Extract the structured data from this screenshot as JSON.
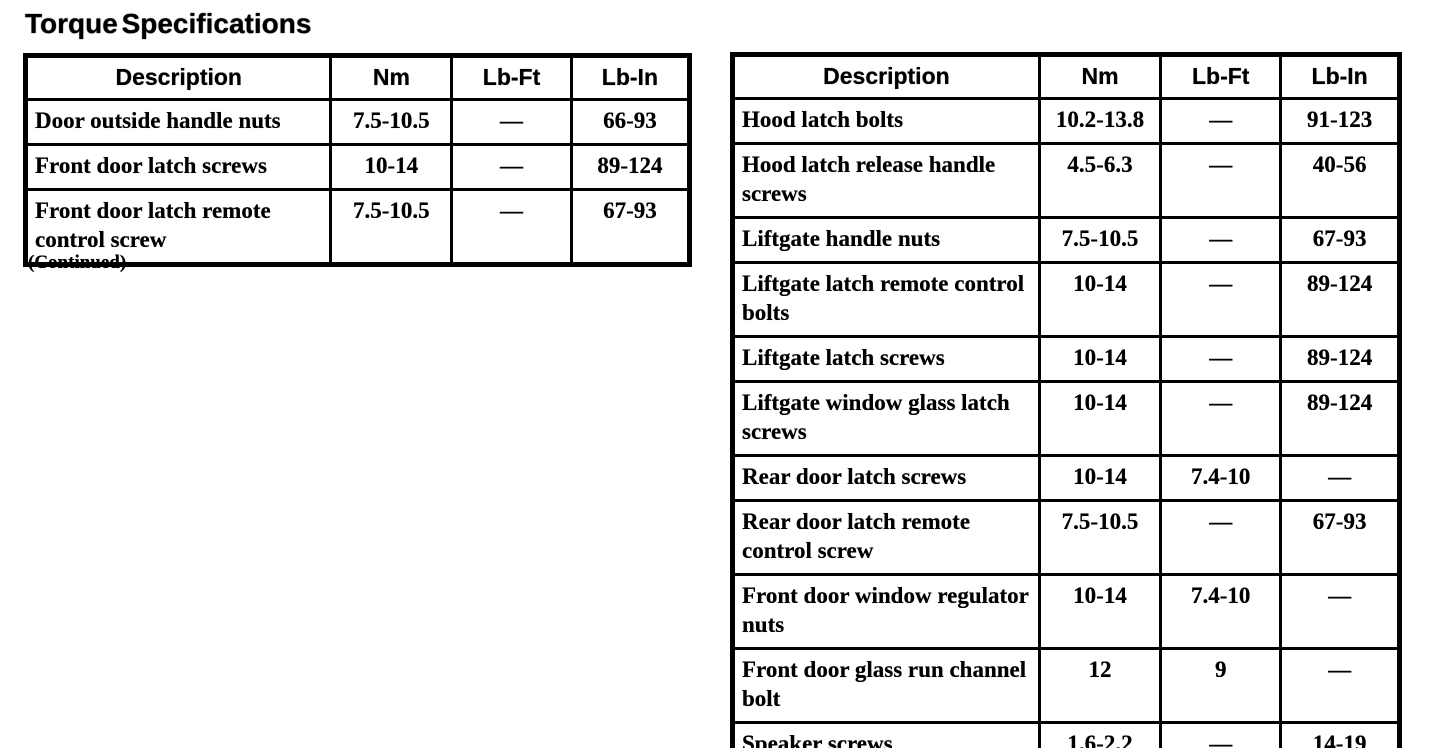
{
  "page": {
    "title": "Torque Specifications",
    "continued_note": "(Continued)"
  },
  "left_table": {
    "headers": [
      "Description",
      "Nm",
      "Lb-Ft",
      "Lb-In"
    ],
    "rows": [
      {
        "description": "Door outside handle nuts",
        "nm": "7.5-10.5",
        "lb_ft": "—",
        "lb_in": "66-93"
      },
      {
        "description": "Front door latch screws",
        "nm": "10-14",
        "lb_ft": "—",
        "lb_in": "89-124"
      },
      {
        "description": "Front door latch remote control screw",
        "nm": "7.5-10.5",
        "lb_ft": "—",
        "lb_in": "67-93"
      }
    ]
  },
  "right_table": {
    "headers": [
      "Description",
      "Nm",
      "Lb-Ft",
      "Lb-In"
    ],
    "rows": [
      {
        "description": "Hood latch bolts",
        "nm": "10.2-13.8",
        "lb_ft": "—",
        "lb_in": "91-123"
      },
      {
        "description": "Hood latch release handle screws",
        "nm": "4.5-6.3",
        "lb_ft": "—",
        "lb_in": "40-56"
      },
      {
        "description": "Liftgate handle nuts",
        "nm": "7.5-10.5",
        "lb_ft": "—",
        "lb_in": "67-93"
      },
      {
        "description": "Liftgate latch remote control bolts",
        "nm": "10-14",
        "lb_ft": "—",
        "lb_in": "89-124"
      },
      {
        "description": "Liftgate latch screws",
        "nm": "10-14",
        "lb_ft": "—",
        "lb_in": "89-124"
      },
      {
        "description": "Liftgate window glass latch screws",
        "nm": "10-14",
        "lb_ft": "—",
        "lb_in": "89-124"
      },
      {
        "description": "Rear door latch screws",
        "nm": "10-14",
        "lb_ft": "7.4-10",
        "lb_in": "—"
      },
      {
        "description": "Rear door latch remote control screw",
        "nm": "7.5-10.5",
        "lb_ft": "—",
        "lb_in": "67-93"
      },
      {
        "description": "Front door window regulator nuts",
        "nm": "10-14",
        "lb_ft": "7.4-10",
        "lb_in": "—"
      },
      {
        "description": "Front door glass run channel bolt",
        "nm": "12",
        "lb_ft": "9",
        "lb_in": "—"
      },
      {
        "description": "Speaker screws",
        "nm": "1.6-2.2",
        "lb_ft": "—",
        "lb_in": "14-19"
      }
    ]
  }
}
